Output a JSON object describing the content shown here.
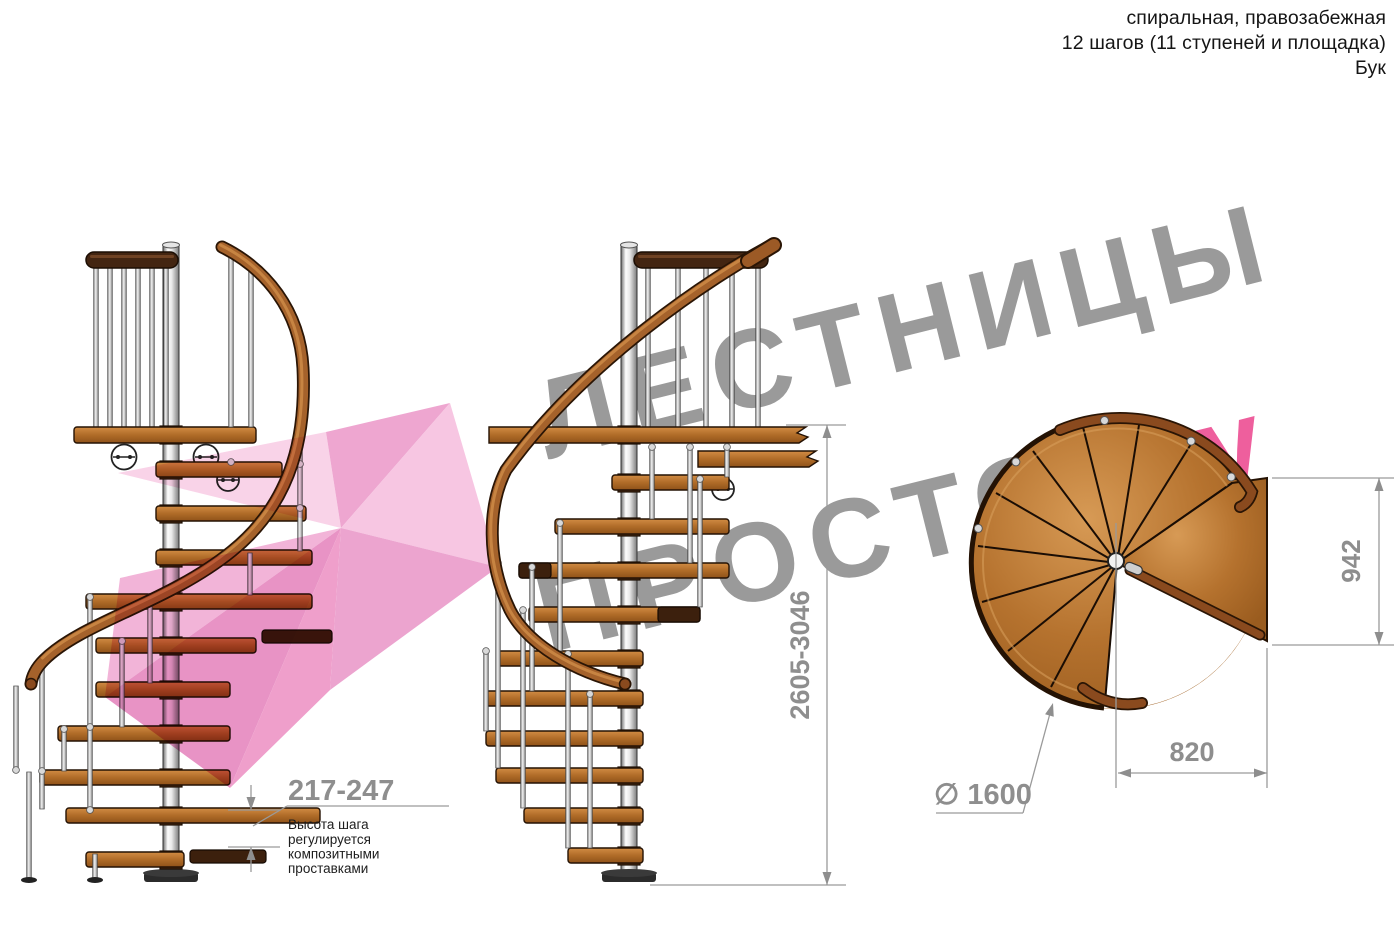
{
  "header": {
    "line1": "спиральная, правозабежная",
    "line2": "12 шагов (11 ступеней и площадка)",
    "line3": "Бук"
  },
  "watermark": {
    "line1": "ЛЕСТНИЦЫ",
    "line2_gray": "ПРОСТО",
    "line2_pink": ".Ру"
  },
  "dimensions": {
    "height_range": "2605-3046",
    "step_height_range": "217-247",
    "step_note_lines": [
      "Высота шага",
      "регулируется",
      "композитными",
      "проставками"
    ],
    "platform_height": "942",
    "platform_width": "820",
    "diameter": "∅ 1600"
  },
  "colors": {
    "wood": "#b5722e",
    "wood_dark": "#3c200d",
    "handrail": "#a5622b",
    "metal": "#c9c9c9",
    "watermark_gray": "#9a9a9a",
    "accent_pink": "#ee5f9d",
    "arrow_pink": "#f2aed6",
    "dimension_gray": "#8e8e8e"
  }
}
